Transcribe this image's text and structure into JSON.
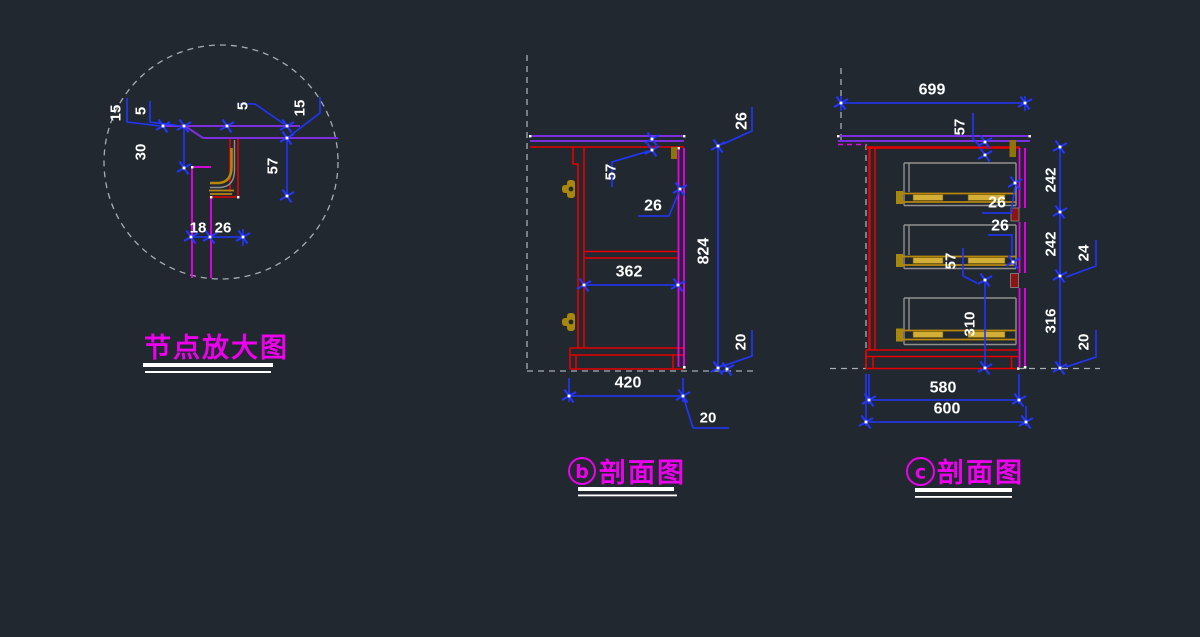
{
  "drawing": {
    "type": "cad-cabinet-sections",
    "colors": {
      "background": "#212830",
      "dimension_blue": "#2236ff",
      "dimension_text": "#ffffff",
      "carcass_red": "#e60000",
      "front_magenta": "#ee00ee",
      "counter_violet": "#7b2fe0",
      "hardware_gold": "#b8860b",
      "drawer_gray": "#909090",
      "reference_dash_gray": "#a7adb5",
      "label_magenta": "#ee00ee"
    },
    "views": {
      "detail": {
        "title": "节点放大图",
        "dims": {
          "left_15": "15",
          "left_5": "5",
          "left_30": "30",
          "top_5": "5",
          "right_15": "15",
          "right_57": "57",
          "bottom_18": "18",
          "bottom_26": "26"
        }
      },
      "section_b": {
        "label_letter": "b",
        "label_title": "剖面图",
        "dims": {
          "top_57": "57",
          "gap_26": "26",
          "top_right_26": "26",
          "height_824": "824",
          "inner_362": "362",
          "bottom_420": "420",
          "right_20": "20",
          "bottom_20": "20"
        }
      },
      "section_c": {
        "label_letter": "c",
        "label_title": "剖面图",
        "dims": {
          "top_699": "699",
          "top_57": "57",
          "drawer1_26": "26",
          "drawer2_26": "26",
          "right_242_a": "242",
          "right_242_b": "242",
          "right_24": "24",
          "mid_57": "57",
          "mid_310": "310",
          "right_316": "316",
          "right_20": "20",
          "bottom_580": "580",
          "bottom_600": "600"
        }
      }
    }
  }
}
